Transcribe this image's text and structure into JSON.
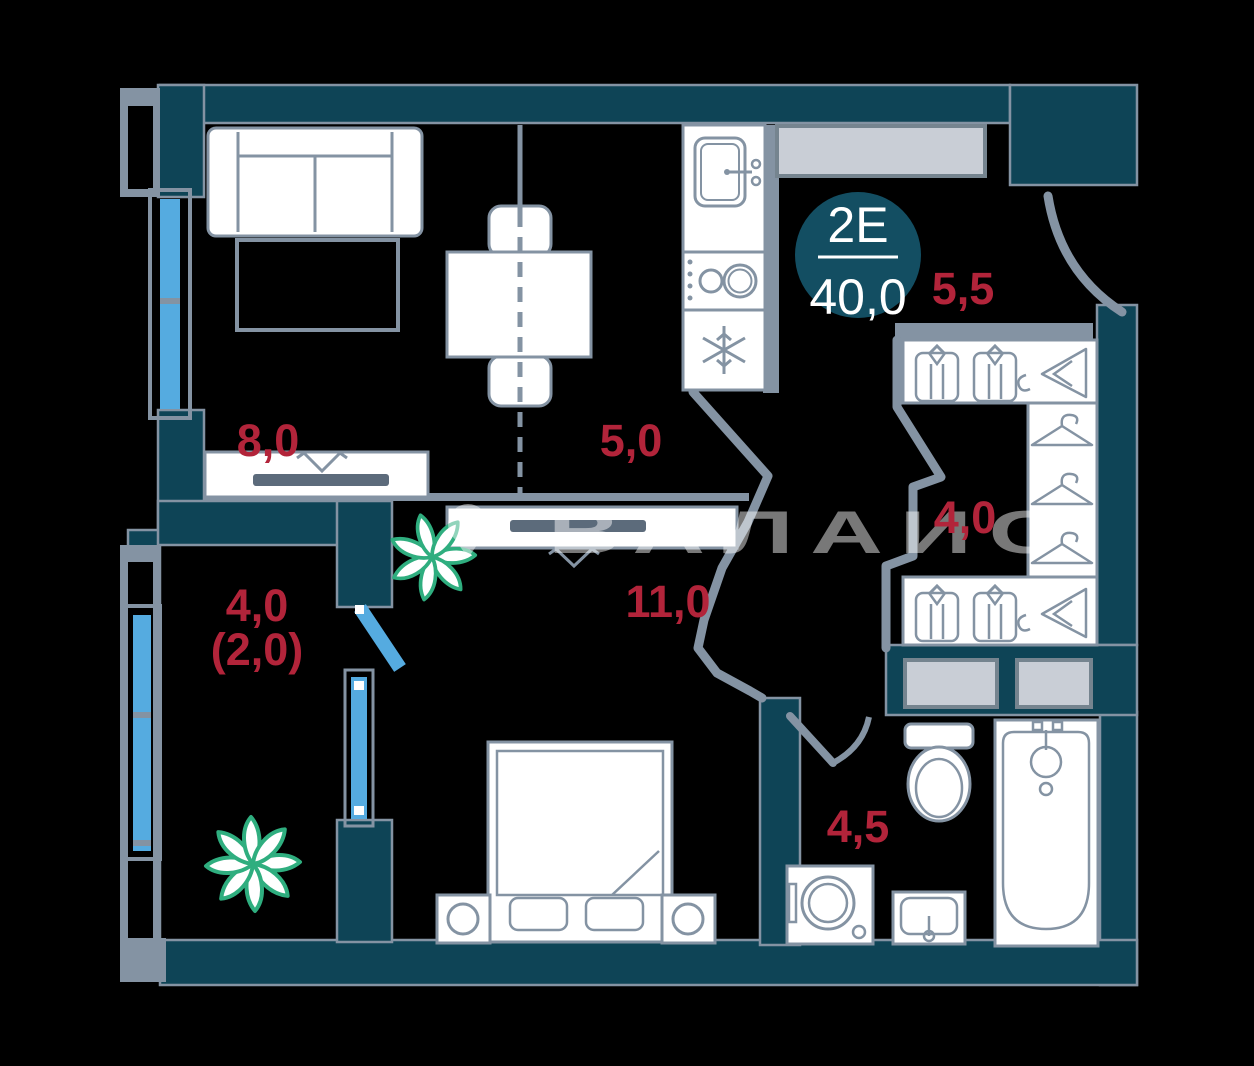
{
  "floorplan": {
    "unit_badge": {
      "type_code": "2Е",
      "total_area": "40,0"
    },
    "room_areas": {
      "living_room": "8,0",
      "kitchen": "5,0",
      "main_room": "11,0",
      "balcony": "4,0",
      "balcony_coefficient": "(2,0)",
      "entry_hall": "5,5",
      "wardrobe": "4,0",
      "bathroom": "4,5"
    },
    "watermark_text": "ВАЛАИС",
    "colors": {
      "background": "#000000",
      "wall": "#0e4456",
      "outline_gray": "#8493a3",
      "window_blue": "#55abe0",
      "label_red": "#b2243a",
      "plant_green": "#2fae7f",
      "badge_fill": "#134e62",
      "counter_gray": "#c9ced6",
      "tv_dark": "#5c6b7b"
    },
    "icons": {
      "fridge-icon": "snowflake",
      "stove-icon": "two-burner-circles",
      "kitchen-sink-icon": "rounded-basin-with-faucet",
      "shirt-icon": "folded-shirt",
      "hanger-icon": "clothes-hanger",
      "hanger-rail-icon": "side-hanger-with-hook",
      "toilet-icon": "tank-and-bowl",
      "bathtub-icon": "tub-with-faucet",
      "washing-machine-icon": "drum-circle",
      "bathroom-sink-icon": "basin-with-tap",
      "plant-icon": "leaf-star",
      "tv-icon": "dark-bar-with-bracket",
      "watermark-pin-icon": "map-pin"
    }
  }
}
